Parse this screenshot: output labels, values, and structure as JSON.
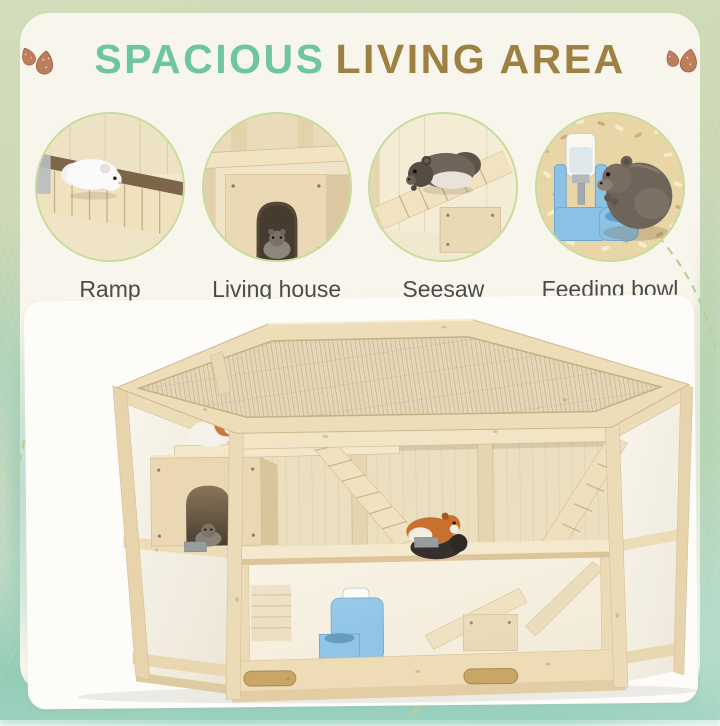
{
  "header": {
    "title_part1": "SPACIOUS",
    "title_part2": "LIVING AREA",
    "left_decoration": "almonds-icon",
    "right_decoration": "almonds-icon"
  },
  "features": [
    {
      "label": "Ramp",
      "scene": "white-hamster-on-wooden-ramp"
    },
    {
      "label": "Living house",
      "scene": "hamster-inside-wooden-house-arched-door"
    },
    {
      "label": "Seesaw",
      "scene": "grey-hamster-on-wooden-seesaw"
    },
    {
      "label": "Feeding bowl",
      "scene": "hamster-eating-at-blue-feeding-bowl"
    }
  ],
  "product": {
    "name": "hexagonal-wooden-hamster-cage-with-mesh-top"
  },
  "colors": {
    "teal": "#6fc5a1",
    "gold": "#9d8042",
    "label": "#4b4b48",
    "ring": "#c7db9b",
    "card": "#f8f6ec",
    "frame-sage": "#ccd7b6",
    "wash-teal": "#8fc9b4",
    "wood": "#f0e3c3",
    "wood-dark": "#d6bd92",
    "feeder-blue": "#8cc2e6",
    "dash": "#b9cf97"
  }
}
